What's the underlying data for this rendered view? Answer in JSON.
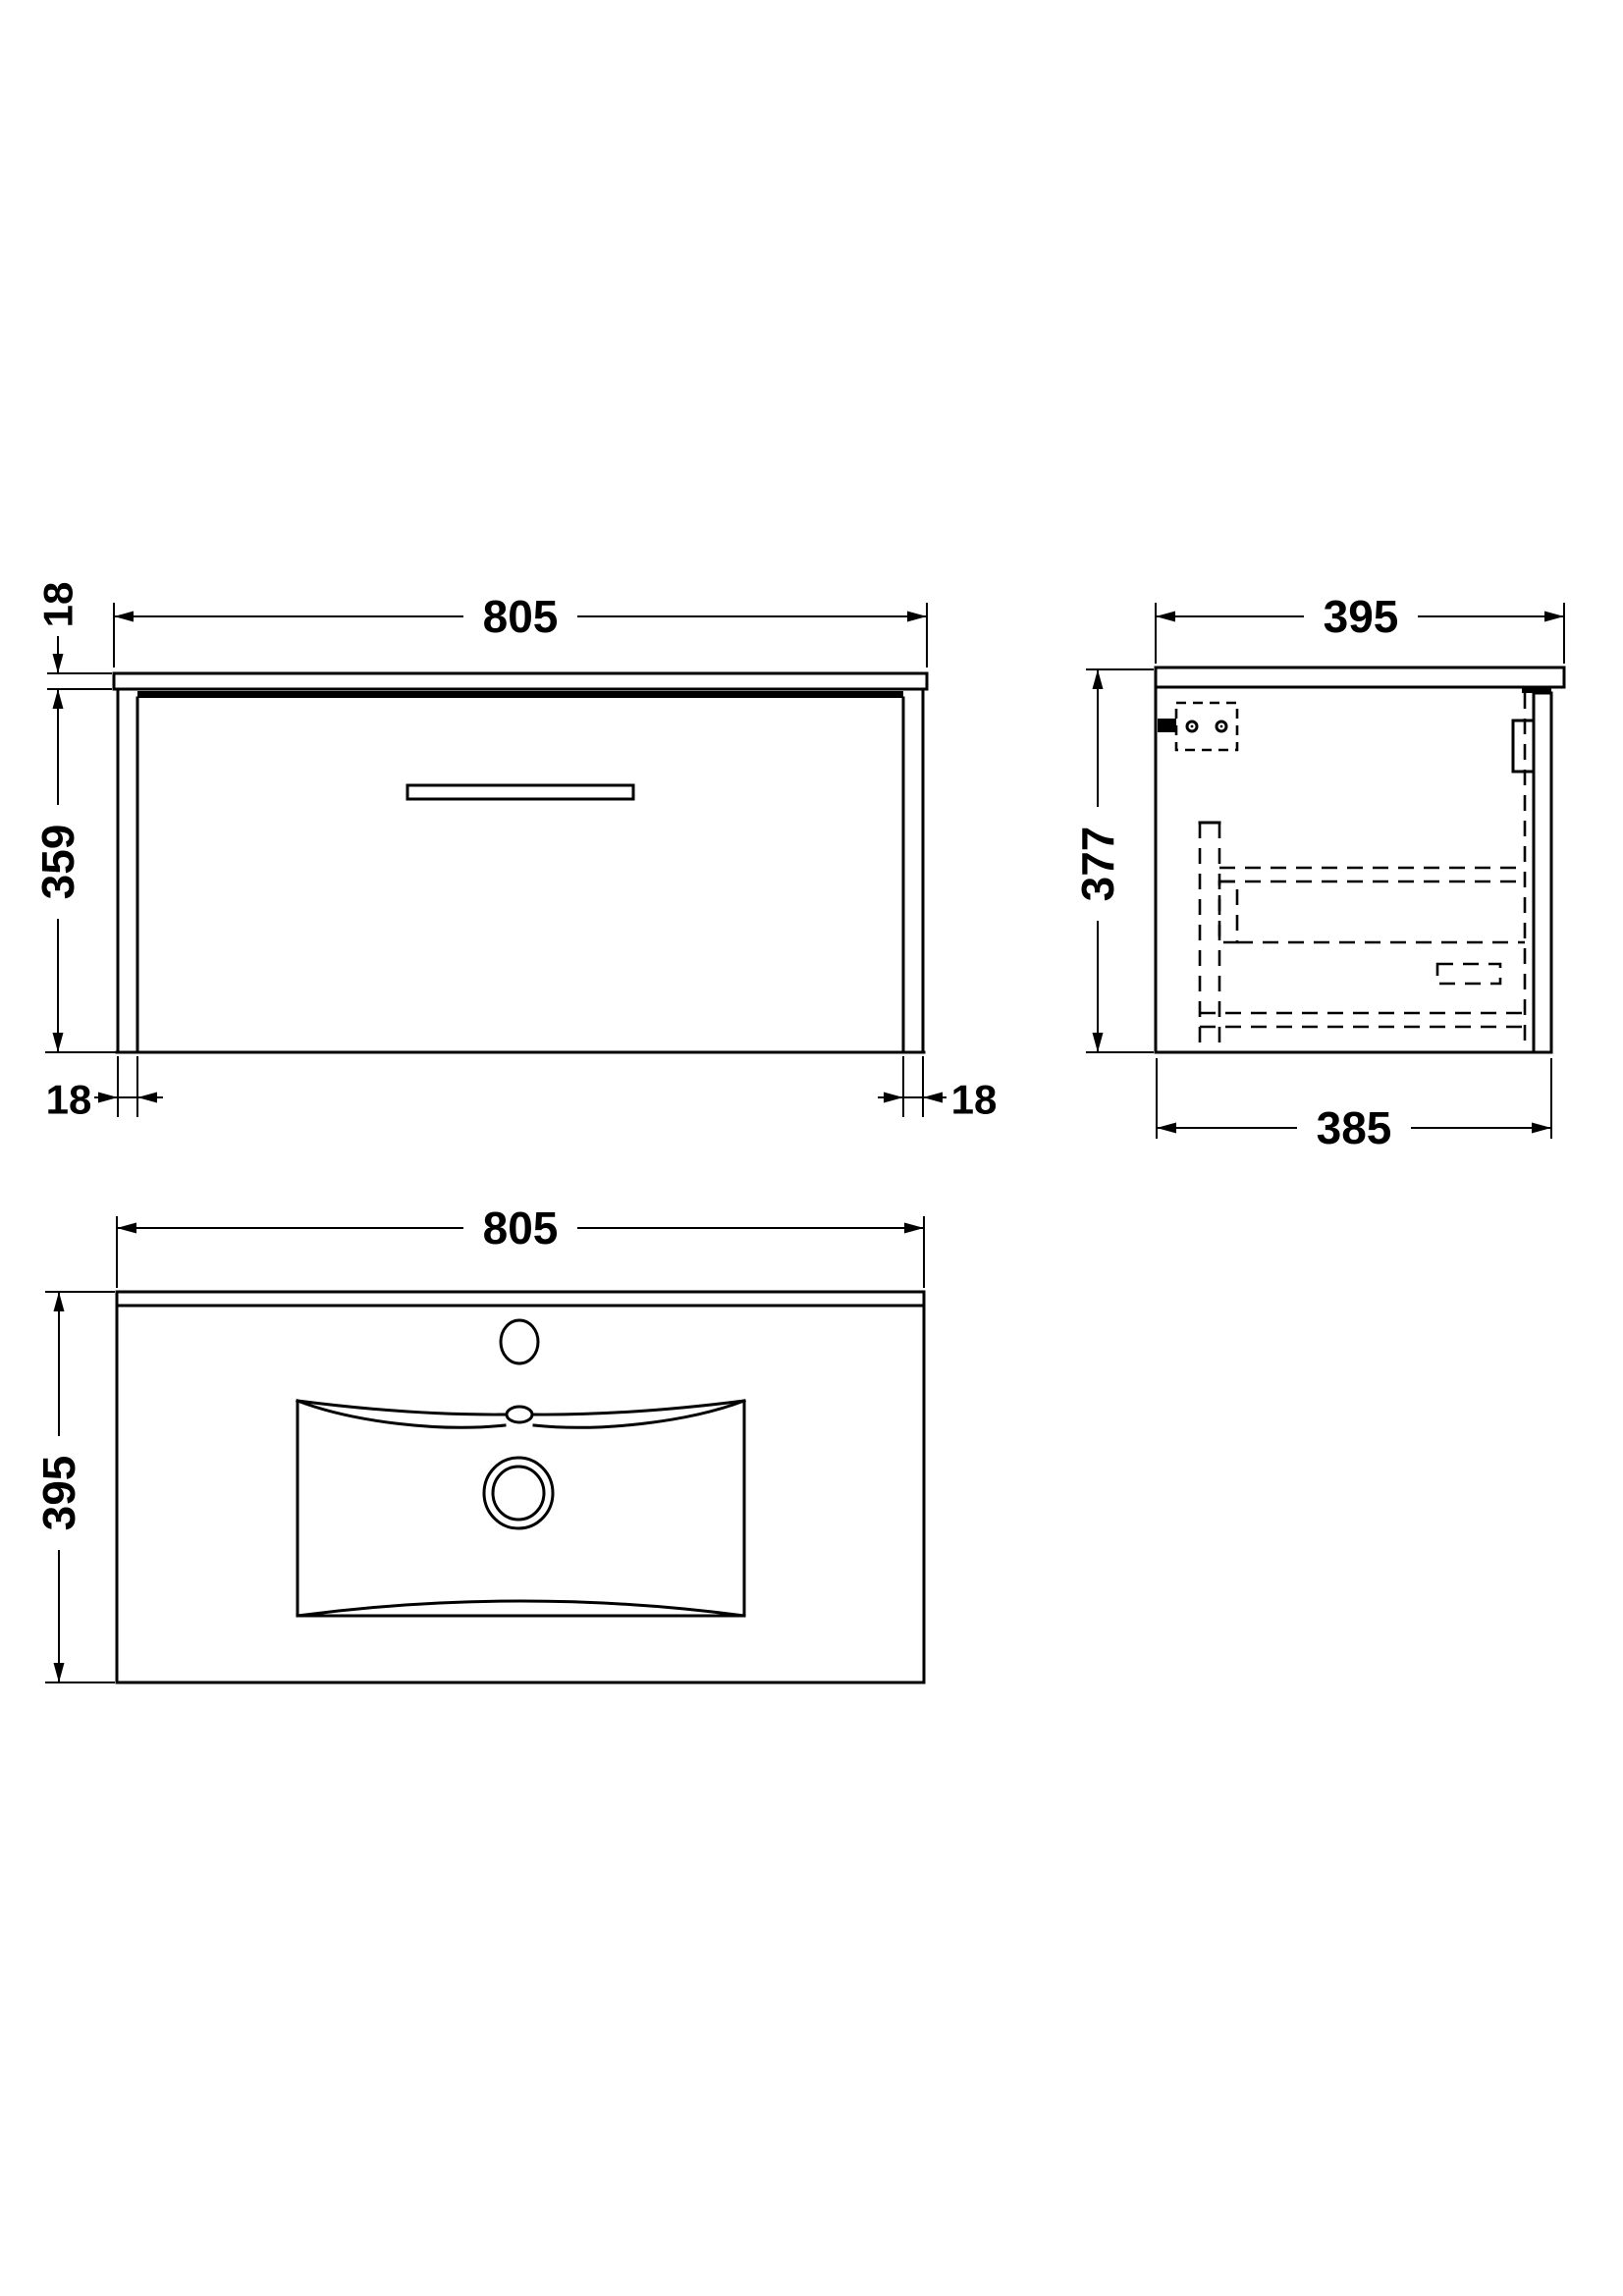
{
  "drawing": {
    "background": "#ffffff",
    "line_color": "#000000",
    "units": "mm",
    "front": {
      "width": "805",
      "worktop_thickness": "18",
      "cabinet_height": "359",
      "left_panel_thickness": "18",
      "right_panel_thickness": "18"
    },
    "side": {
      "worktop_depth": "395",
      "overall_height": "377",
      "cabinet_depth": "385"
    },
    "plan": {
      "width": "805",
      "depth": "395"
    }
  }
}
